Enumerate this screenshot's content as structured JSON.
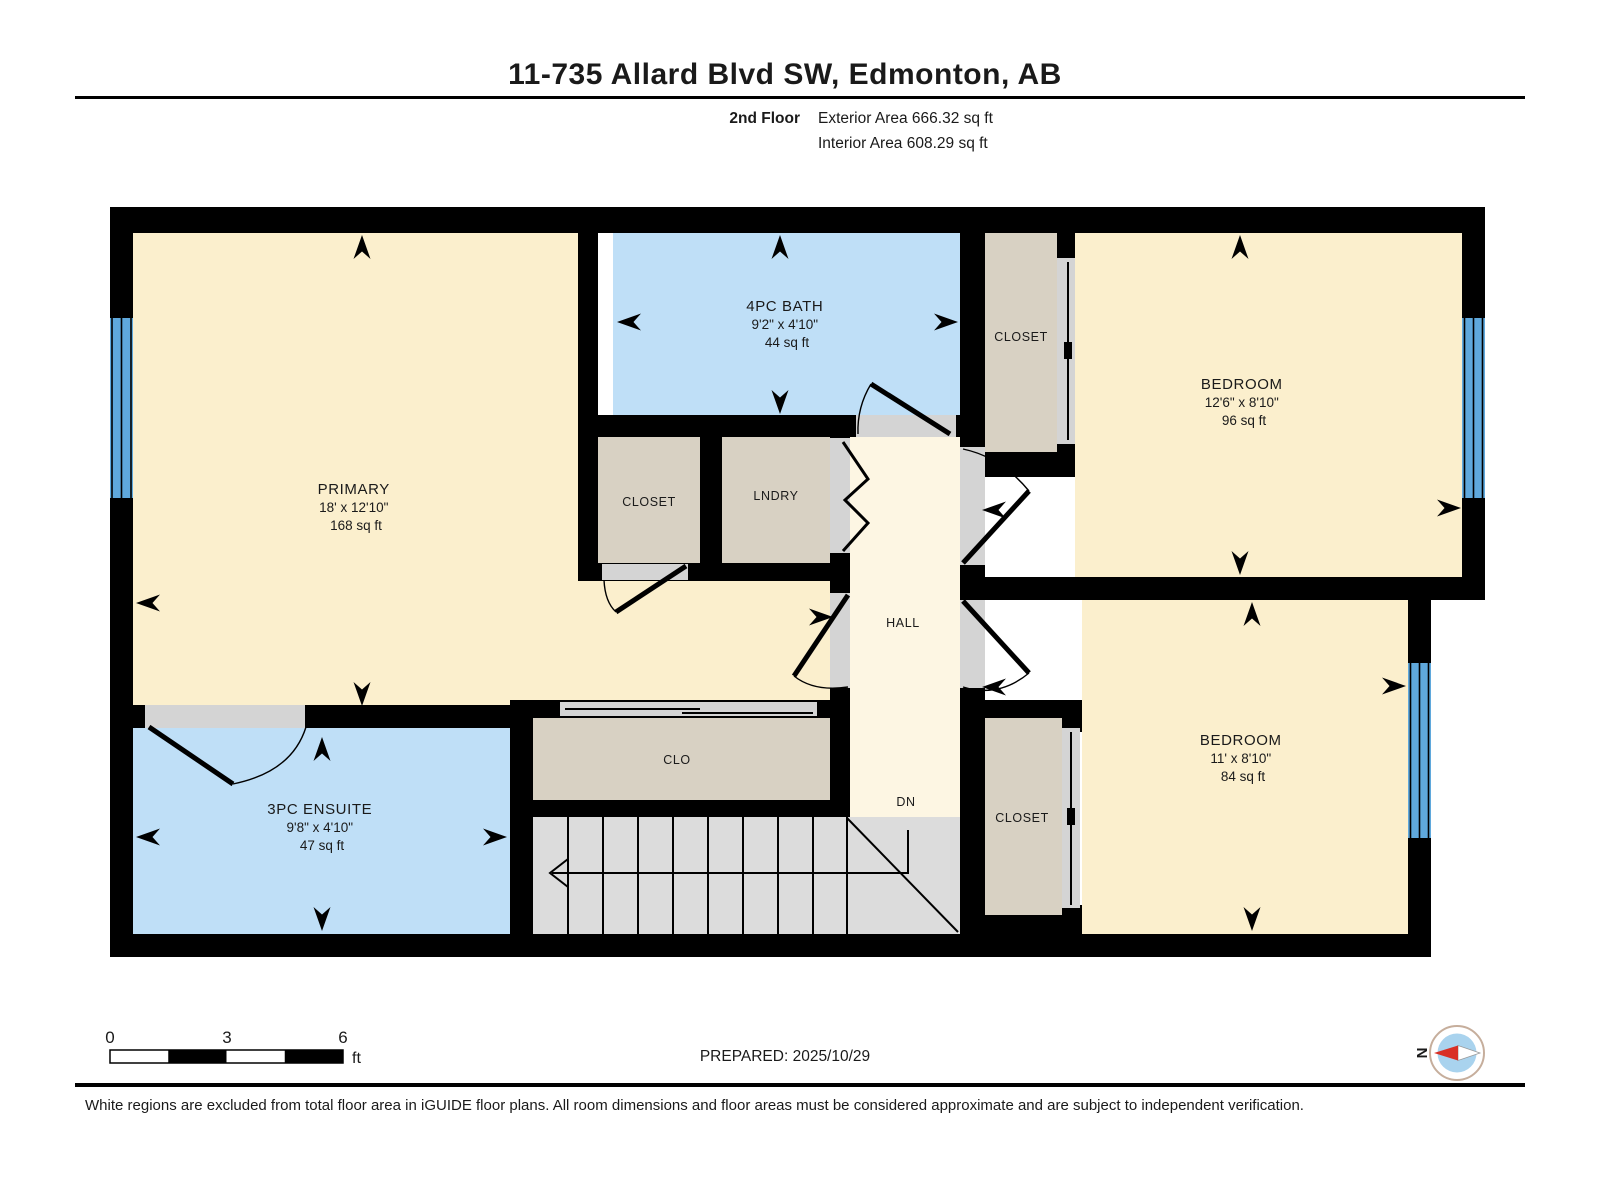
{
  "header": {
    "title": "11-735 Allard Blvd SW, Edmonton, AB",
    "floor_label": "2nd Floor",
    "exterior_area": "Exterior Area 666.32 sq ft",
    "interior_area": "Interior Area 608.29 sq ft"
  },
  "rooms": [
    {
      "name": "PRIMARY",
      "dims": "18' x 12'10\"",
      "area": "168 sq ft"
    },
    {
      "name": "4PC BATH",
      "dims": "9'2\" x 4'10\"",
      "area": "44 sq ft"
    },
    {
      "name": "BEDROOM",
      "dims": "12'6\" x 8'10\"",
      "area": "96 sq ft"
    },
    {
      "name": "BEDROOM",
      "dims": "11' x 8'10\"",
      "area": "84 sq ft"
    },
    {
      "name": "3PC ENSUITE",
      "dims": "9'8\" x 4'10\"",
      "area": "47 sq ft"
    }
  ],
  "labels": {
    "closet_top_right": "CLOSET",
    "closet_middle": "CLOSET",
    "laundry": "LNDRY",
    "hall": "HALL",
    "stairs_down": "DN",
    "closet_hall": "CLO",
    "closet_bottom_right": "CLOSET"
  },
  "scale_bar": {
    "tick_0": "0",
    "tick_3": "3",
    "tick_6": "6",
    "unit": "ft"
  },
  "prepared_label": "PREPARED: 2025/10/29",
  "compass": {
    "north_label": "N"
  },
  "footer": {
    "disclaimer": "White regions are excluded from total floor area in iGUIDE floor plans. All room dimensions and floor areas must be considered approximate and are subject to independent verification."
  },
  "colors": {
    "wall": "#000000",
    "room_cream": "#FBEFCD",
    "hall_cream": "#FDF6E3",
    "wet_room_blue": "#BFDFF7",
    "closet_tan": "#D8D1C3",
    "stairs_grey": "#DCDCDC",
    "door_gap_grey": "#D4D4D4",
    "window_blue": "#5FA8DC",
    "compass_needle_red": "#D93025",
    "compass_disc_blue": "#A9D3EE"
  }
}
